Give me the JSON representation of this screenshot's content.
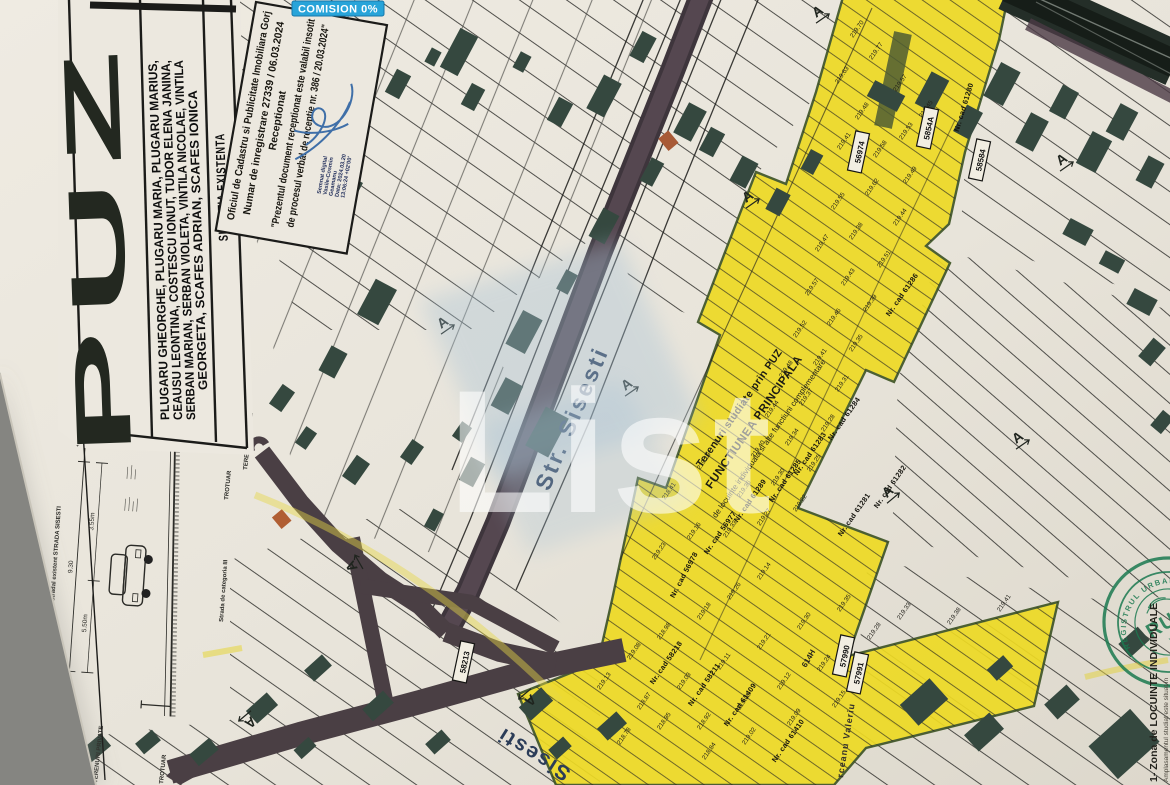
{
  "badge": {
    "label": "COMISION 0%",
    "bg": "#28a4d9"
  },
  "title_block": {
    "puz": "PUZ",
    "names_lines": [
      "PLUGARU GHEORGHE, PLUGARU MARIA, PLUGARU MARIUS,",
      "CEAUSU LEONTINA, COSTESCU IONUT, TUDOR ELENA JANINA,",
      "SERBAN MARIAN, SERBAN VIOLETA, VINTILA NICOLAE, VINTILA",
      "GEORGETA, SCAFES ADRIAN, SCAFES IONICA"
    ],
    "situatia": "SITUATIA EXISTENTA"
  },
  "stamp": {
    "lines": [
      "Oficiul de Cadastru si Publicitate Imobiliara Gorj",
      "Numar de inregistrare 27339 / 06.03.2024",
      "Receptionat",
      "\"Prezentul document receptionat este valabil insotit",
      "de procesul verbal de receptie nr. 386 / 20.03.2024\""
    ],
    "signature_lines": [
      "Semnat digital",
      "Vasile-Cosmin",
      "Geamanu",
      "Data: 2024.03.20",
      "13:06:24 +02'00'"
    ]
  },
  "watermark": {
    "text": "List"
  },
  "streets": {
    "main": "Str. Sisesti",
    "bottom": "Sisesti",
    "right": "rceanu Valeriu",
    "code": "614H",
    "category": "Strada de categoria III"
  },
  "zone_labels": {
    "l1": "Terenuri studiate prin PUZ",
    "l2": "FUNCTIUNEA PRINCIPALA",
    "l3": "de locuinte individuala si alte functiuni complementare"
  },
  "legend": {
    "line1": "1- Zona de LOCUINTE INDIVIDUALE",
    "line2": "Amplasamentul studiat este situat in"
  },
  "seal": {
    "org": "REGISTRUL URBANISTILOR DIN ROMANIA",
    "abbr": "RUR",
    "name": "Viorel"
  },
  "cross_section": {
    "title": "Profil stradal existent STRADA SISESTI",
    "dims": [
      "1.50",
      "9.30",
      "1.50",
      "5.50m",
      "3.55m"
    ],
    "labels": {
      "trotuar": "TROTUAR",
      "terenuri": "TERENURI PRIVATE"
    }
  },
  "cad_boxes": [
    {
      "t": "56974",
      "x": 859,
      "y": 152,
      "r": -78
    },
    {
      "t": "5854A",
      "x": 928,
      "y": 128,
      "r": -78
    },
    {
      "t": "58584",
      "x": 980,
      "y": 160,
      "r": -78
    },
    {
      "t": "58213",
      "x": 464,
      "y": 662,
      "r": -78
    },
    {
      "t": "57990",
      "x": 844,
      "y": 656,
      "r": -78
    },
    {
      "t": "57991",
      "x": 858,
      "y": 673,
      "r": -78
    }
  ],
  "cad_labels": [
    {
      "t": "Nr. cad 61280",
      "x": 966,
      "y": 108,
      "r": -73
    },
    {
      "t": "Nr. cad 61286",
      "x": 904,
      "y": 296,
      "r": -55
    },
    {
      "t": "Nr. cad 61284",
      "x": 846,
      "y": 420,
      "r": -55
    },
    {
      "t": "Nr. cad 61283",
      "x": 812,
      "y": 455,
      "r": -55
    },
    {
      "t": "Nr. cad 61285",
      "x": 787,
      "y": 482,
      "r": -55
    },
    {
      "t": "Nr. cad 61289",
      "x": 752,
      "y": 502,
      "r": -55
    },
    {
      "t": "Nr. cad 56977",
      "x": 722,
      "y": 534,
      "r": -55
    },
    {
      "t": "Nr. cad 61281",
      "x": 856,
      "y": 516,
      "r": -55
    },
    {
      "t": "Nr. cad 61282",
      "x": 892,
      "y": 488,
      "r": -55
    },
    {
      "t": "Nr. cad 56978",
      "x": 686,
      "y": 576,
      "r": -62
    },
    {
      "t": "Nr. cad 58218",
      "x": 668,
      "y": 664,
      "r": -55
    },
    {
      "t": "Nr. cad 58211",
      "x": 706,
      "y": 686,
      "r": -55
    },
    {
      "t": "Nr. cad 61409",
      "x": 742,
      "y": 706,
      "r": -55
    },
    {
      "t": "Nr. cad 61410",
      "x": 790,
      "y": 742,
      "r": -55
    }
  ],
  "map_symbols": {
    "char": "A",
    "positions": [
      {
        "x": 443,
        "y": 323,
        "r": -35
      },
      {
        "x": 627,
        "y": 385,
        "r": -35
      },
      {
        "x": 748,
        "y": 197,
        "r": -35
      },
      {
        "x": 818,
        "y": 12,
        "r": -35
      },
      {
        "x": 250,
        "y": 722,
        "r": 140
      },
      {
        "x": 530,
        "y": 700,
        "r": 140
      },
      {
        "x": 1018,
        "y": 438,
        "r": -35
      },
      {
        "x": 888,
        "y": 492,
        "r": -40
      },
      {
        "x": 352,
        "y": 566,
        "r": -120
      },
      {
        "x": 1062,
        "y": 160,
        "r": -35
      }
    ]
  },
  "elevations": [
    {
      "x": 853,
      "y": 38,
      "v": "219.70"
    },
    {
      "x": 872,
      "y": 60,
      "v": "219.77"
    },
    {
      "x": 838,
      "y": 84,
      "v": "219.63"
    },
    {
      "x": 896,
      "y": 92,
      "v": "219.57"
    },
    {
      "x": 858,
      "y": 120,
      "v": "219.48"
    },
    {
      "x": 902,
      "y": 140,
      "v": "219.53"
    },
    {
      "x": 922,
      "y": 118,
      "v": "219.45"
    },
    {
      "x": 876,
      "y": 158,
      "v": "219.58"
    },
    {
      "x": 840,
      "y": 150,
      "v": "219.41"
    },
    {
      "x": 906,
      "y": 184,
      "v": "219.49"
    },
    {
      "x": 868,
      "y": 196,
      "v": "219.62"
    },
    {
      "x": 834,
      "y": 210,
      "v": "219.55"
    },
    {
      "x": 896,
      "y": 226,
      "v": "219.44"
    },
    {
      "x": 852,
      "y": 240,
      "v": "219.38"
    },
    {
      "x": 818,
      "y": 252,
      "v": "219.47"
    },
    {
      "x": 880,
      "y": 268,
      "v": "219.51"
    },
    {
      "x": 844,
      "y": 286,
      "v": "219.43"
    },
    {
      "x": 808,
      "y": 296,
      "v": "219.57"
    },
    {
      "x": 866,
      "y": 312,
      "v": "219.39"
    },
    {
      "x": 830,
      "y": 326,
      "v": "219.46"
    },
    {
      "x": 796,
      "y": 338,
      "v": "219.52"
    },
    {
      "x": 852,
      "y": 352,
      "v": "219.35"
    },
    {
      "x": 816,
      "y": 366,
      "v": "219.41"
    },
    {
      "x": 782,
      "y": 378,
      "v": "219.48"
    },
    {
      "x": 838,
      "y": 392,
      "v": "219.31"
    },
    {
      "x": 802,
      "y": 406,
      "v": "219.37"
    },
    {
      "x": 768,
      "y": 418,
      "v": "219.44"
    },
    {
      "x": 824,
      "y": 432,
      "v": "219.28"
    },
    {
      "x": 788,
      "y": 446,
      "v": "219.34"
    },
    {
      "x": 754,
      "y": 458,
      "v": "219.40"
    },
    {
      "x": 810,
      "y": 472,
      "v": "219.25"
    },
    {
      "x": 774,
      "y": 486,
      "v": "219.30"
    },
    {
      "x": 740,
      "y": 498,
      "v": "219.36"
    },
    {
      "x": 796,
      "y": 512,
      "v": "219.22"
    },
    {
      "x": 760,
      "y": 526,
      "v": "219.27"
    },
    {
      "x": 726,
      "y": 538,
      "v": "219.33"
    },
    {
      "x": 700,
      "y": 470,
      "v": "219.19"
    },
    {
      "x": 665,
      "y": 500,
      "v": "218.41"
    },
    {
      "x": 690,
      "y": 540,
      "v": "219.16"
    },
    {
      "x": 655,
      "y": 560,
      "v": "219.23"
    },
    {
      "x": 600,
      "y": 690,
      "v": "219.13"
    },
    {
      "x": 630,
      "y": 660,
      "v": "219.08"
    },
    {
      "x": 660,
      "y": 640,
      "v": "218.98"
    },
    {
      "x": 700,
      "y": 620,
      "v": "219.18"
    },
    {
      "x": 730,
      "y": 600,
      "v": "219.26"
    },
    {
      "x": 760,
      "y": 580,
      "v": "219.14"
    },
    {
      "x": 640,
      "y": 710,
      "v": "218.87"
    },
    {
      "x": 680,
      "y": 690,
      "v": "219.03"
    },
    {
      "x": 720,
      "y": 670,
      "v": "219.11"
    },
    {
      "x": 760,
      "y": 650,
      "v": "219.21"
    },
    {
      "x": 800,
      "y": 630,
      "v": "219.30"
    },
    {
      "x": 840,
      "y": 612,
      "v": "219.35"
    },
    {
      "x": 700,
      "y": 730,
      "v": "218.92"
    },
    {
      "x": 740,
      "y": 710,
      "v": "219.05"
    },
    {
      "x": 780,
      "y": 690,
      "v": "219.12"
    },
    {
      "x": 820,
      "y": 672,
      "v": "219.24"
    },
    {
      "x": 870,
      "y": 640,
      "v": "219.28"
    },
    {
      "x": 900,
      "y": 620,
      "v": "219.33"
    },
    {
      "x": 620,
      "y": 745,
      "v": "218.78"
    },
    {
      "x": 660,
      "y": 730,
      "v": "218.95"
    },
    {
      "x": 705,
      "y": 760,
      "v": "218.84"
    },
    {
      "x": 745,
      "y": 745,
      "v": "219.02"
    },
    {
      "x": 790,
      "y": 726,
      "v": "219.09"
    },
    {
      "x": 835,
      "y": 708,
      "v": "219.15"
    },
    {
      "x": 950,
      "y": 625,
      "v": "219.38"
    },
    {
      "x": 1000,
      "y": 612,
      "v": "219.41"
    }
  ],
  "colors": {
    "paper": "#e9e5dc",
    "yellow_zone": "#eeda24",
    "building": "#35483f",
    "road": "#4a3f47",
    "dark_road": "#242e28",
    "badge_bg": "#28a4d9",
    "seal_green": "#1b7a50",
    "signature_blue": "#3f6fa8",
    "street_label": "#2b3c58"
  }
}
